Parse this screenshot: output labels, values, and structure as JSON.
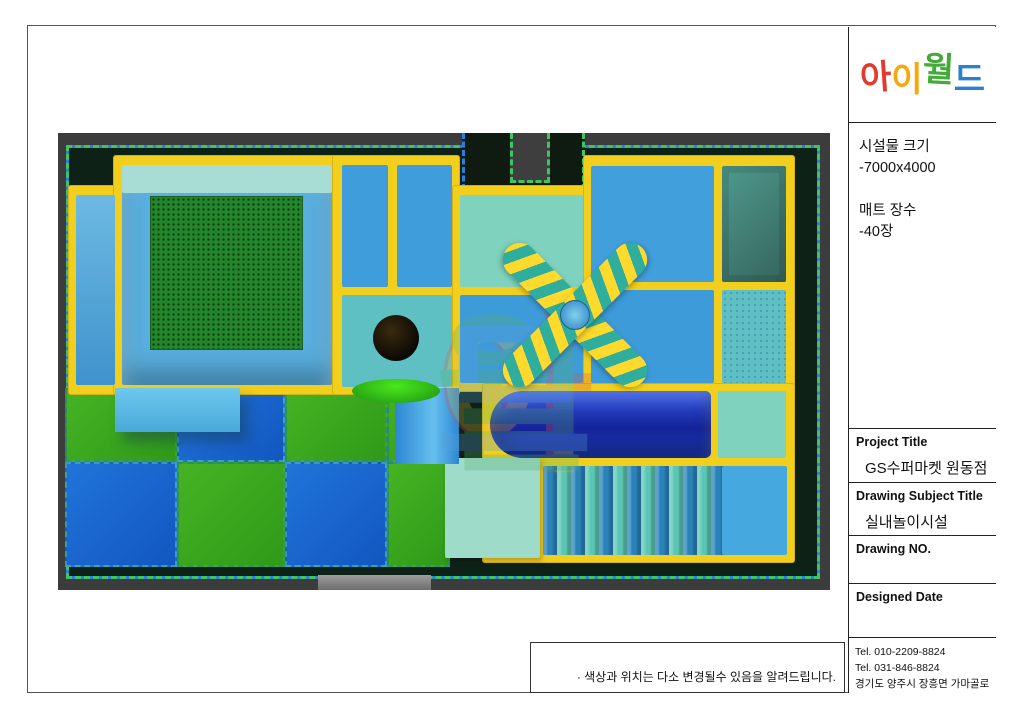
{
  "logo": {
    "chars": [
      {
        "ch": "아",
        "color": "#e23a2e"
      },
      {
        "ch": "이",
        "color": "#f6a90f"
      },
      {
        "ch": "월",
        "color": "#43a938"
      },
      {
        "ch": "드",
        "color": "#2f7fd0"
      }
    ]
  },
  "title_block": {
    "size_label": "시설물 크기",
    "size_value": "-7000x4000",
    "mat_label": "매트 장수",
    "mat_value": "-40장",
    "project_label": "Project Title",
    "project_value": "GS수퍼마켓 원동점",
    "subject_label": "Drawing Subject Title",
    "subject_value": "실내놀이시설",
    "drawing_no_label": "Drawing NO.",
    "designed_date_label": "Designed Date",
    "tel1": "Tel. 010-2209-8824",
    "tel2": "Tel. 031-846-8824",
    "address": "경기도 양주시 장흥면 가마골로 281"
  },
  "note": "· 색상과 위치는 다소 변경될수 있음을 알려드립니다.",
  "watermark": {
    "chars": [
      {
        "ch": "아",
        "color": "#d85a4a"
      },
      {
        "ch": "이",
        "color": "#e0b63a"
      },
      {
        "ch": "월",
        "color": "#57b06a"
      },
      {
        "ch": "드",
        "color": "#5f9fd6"
      }
    ]
  },
  "colors": {
    "frame_yellow": "#f2cf1d",
    "mat_blue": "#41a0dc",
    "mat_teal": "#7fd3be",
    "trampoline_green": "#23852c",
    "floor_mat_green": "#3fae2a",
    "floor_mat_blue": "#1f6fd8",
    "slide_blue": "#1b34c8",
    "wall_gray": "#3c3c3c",
    "perimeter_green": "#3fc464",
    "perimeter_blue": "#2e7ce0"
  }
}
